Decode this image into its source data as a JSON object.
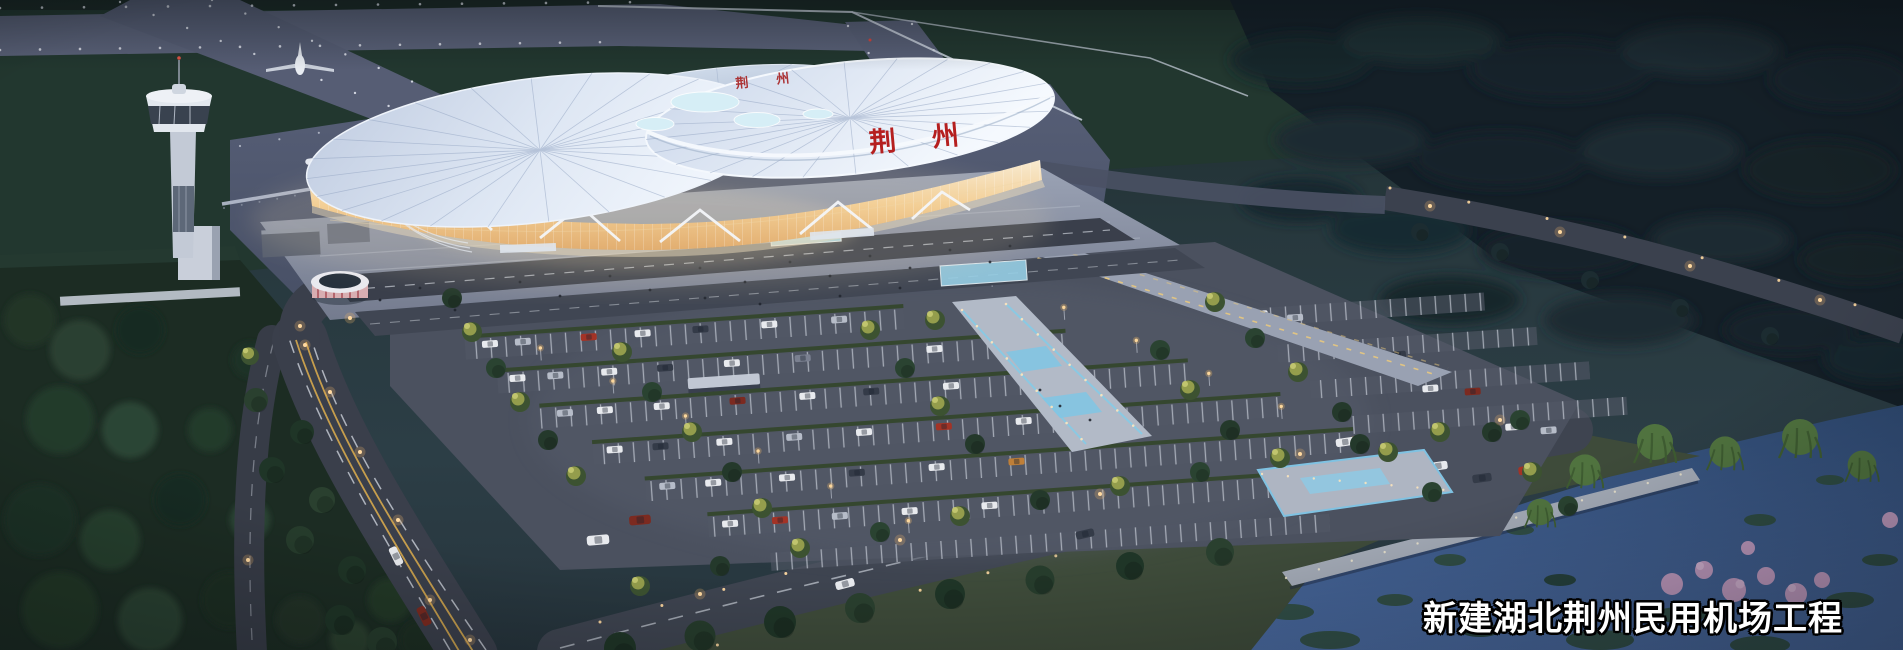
{
  "caption": {
    "text": "新建湖北荆州民用机场工程"
  },
  "terminal": {
    "roof_sign": "荆州",
    "roof_sign_far": "荆州"
  },
  "palette": {
    "dusk_ground": "#223137",
    "forest_dark": "#15232b",
    "airside_grass": "#22372f",
    "runway_grey": "#5a6178",
    "apron_grey": "#4e5569",
    "road_asphalt": "#3c414d",
    "roof_light": "#eef3fb",
    "roof_shade": "#b7c4d8",
    "skylight_cyan": "#d6eef6",
    "facade_glow_top": "#f8ead0",
    "facade_glow_bottom": "#e2ae70",
    "sign_red": "#b51f1f",
    "plaza_grey": "#98a0b2",
    "parking_grey": "#4b515f",
    "marking_white": "#e2e7ee",
    "hedge_green": "#35472f",
    "tree_dark": "#233a2b",
    "tree_lit": "#99a14e",
    "water_blue": "#3d5f94",
    "pier_grey": "#a3aab6",
    "willow_green": "#50733f",
    "blossom_pink": "#c9a0c4",
    "street_lamp": "#ffd9a0",
    "pool_blue": "#8fd0e8",
    "caption_fill": "#ffffff",
    "caption_outline": "#000000"
  }
}
